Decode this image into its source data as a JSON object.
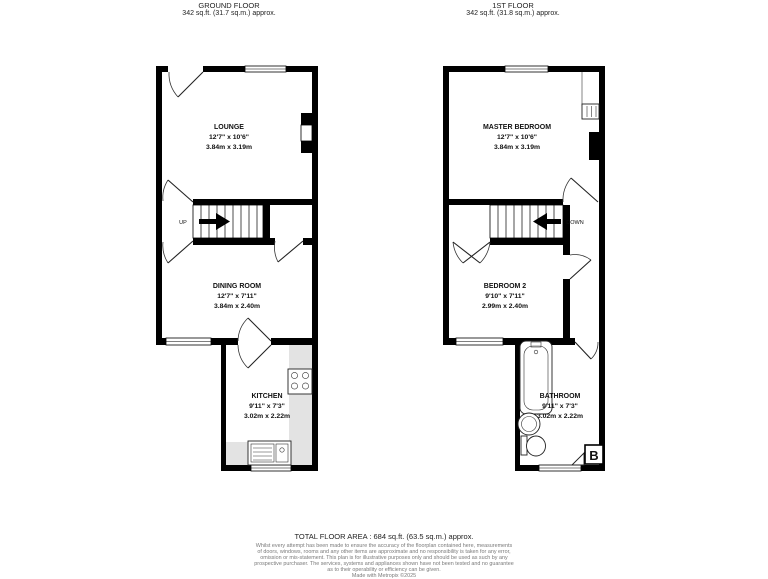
{
  "floors": {
    "ground": {
      "title": "GROUND FLOOR",
      "area": "342 sq.ft. (31.7 sq.m.) approx."
    },
    "first": {
      "title": "1ST FLOOR",
      "area": "342 sq.ft. (31.8 sq.m.) approx."
    }
  },
  "rooms": {
    "lounge": {
      "name": "LOUNGE",
      "imperial": "12'7\" x 10'6\"",
      "metric": "3.84m x 3.19m"
    },
    "dining": {
      "name": "DINING ROOM",
      "imperial": "12'7\" x 7'11\"",
      "metric": "3.84m x 2.40m"
    },
    "kitchen": {
      "name": "KITCHEN",
      "imperial": "9'11\" x 7'3\"",
      "metric": "3.02m x 2.22m"
    },
    "master": {
      "name": "MASTER BEDROOM",
      "imperial": "12'7\" x 10'6\"",
      "metric": "3.84m x 3.19m"
    },
    "bedroom2": {
      "name": "BEDROOM 2",
      "imperial": "9'10\" x 7'11\"",
      "metric": "2.99m x 2.40m"
    },
    "bathroom": {
      "name": "BATHROOM",
      "imperial": "9'11\" x 7'3\"",
      "metric": "3.02m x 2.22m"
    }
  },
  "stairs": {
    "up": "UP",
    "down": "DOWN"
  },
  "boiler_label": "B",
  "footer": {
    "total": "TOTAL FLOOR AREA : 684 sq.ft. (63.5 sq.m.) approx.",
    "disclaimer": [
      "Whilst every attempt has been made to ensure the accuracy of the floorplan contained here, measurements",
      "of doors, windows, rooms and any other items are approximate and no responsibility is taken for any error,",
      "omission or mis-statement. This plan is for illustrative purposes only and should be used as such by any",
      "prospective purchaser. The services, systems and appliances shown have not been tested and no guarantee",
      "as to their operability or efficiency can be given.",
      "Made with Metropix ©2025"
    ]
  },
  "colors": {
    "wall": "#000000",
    "counter": "#e3e3e3",
    "text": "#111111",
    "disclaimer": "#7a7a7a"
  }
}
